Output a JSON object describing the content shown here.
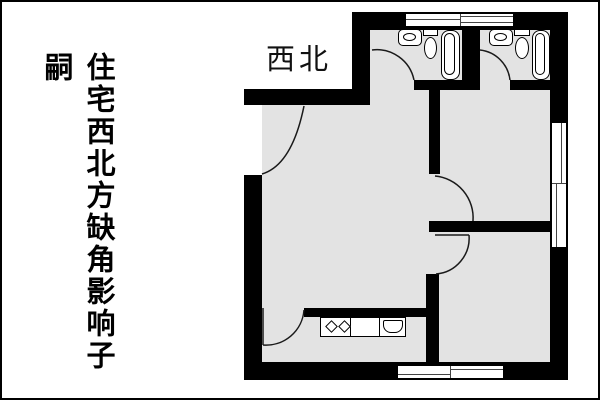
{
  "page": {
    "background_color": "#ffffff",
    "frame_color": "#000000"
  },
  "caption": {
    "text": "住宅西北方缺角影响子嗣",
    "color": "#000000",
    "orientation": "vertical"
  },
  "plan": {
    "direction_label": "西北",
    "colors": {
      "wall": "#000000",
      "floor": "#e3e3e3",
      "fixture_fill": "#ffffff",
      "fixture_outline": "#000000"
    },
    "fixtures": [
      "sink-icon",
      "toilet-icon",
      "bathtub-icon",
      "sink-icon",
      "toilet-icon",
      "bathtub-icon",
      "stove-burners-icon",
      "kitchen-sink-icon"
    ],
    "features": {
      "missing_corner": "northwest",
      "door_count": 6,
      "window_count": 3
    }
  }
}
